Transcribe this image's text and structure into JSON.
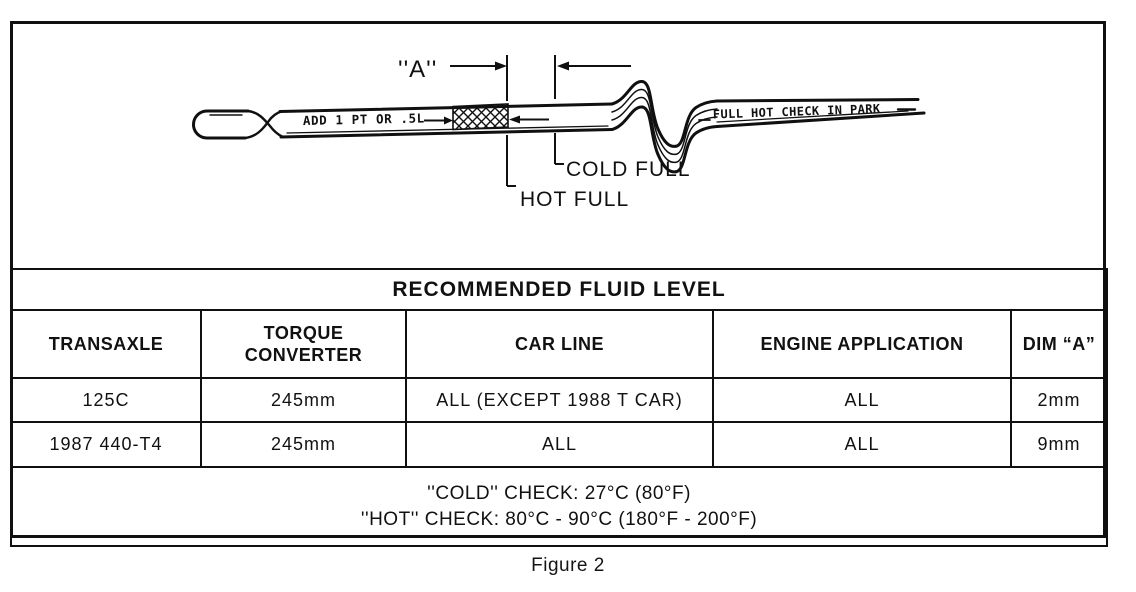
{
  "figure": {
    "caption": "Figure 2"
  },
  "diagram": {
    "dim_a_label": "''A''",
    "dipstick_add_text": "ADD 1 PT OR .5L",
    "dipstick_full_text": "FULL HOT CHECK IN PARK",
    "cold_full_label": "COLD FULL",
    "hot_full_label": "HOT FULL"
  },
  "table": {
    "title": "RECOMMENDED FLUID LEVEL",
    "columns": [
      "TRANSAXLE",
      "TORQUE CONVERTER",
      "CAR LINE",
      "ENGINE APPLICATION",
      "DIM “A”"
    ],
    "rows": [
      [
        "125C",
        "245mm",
        "ALL (EXCEPT 1988 T CAR)",
        "ALL",
        "2mm"
      ],
      [
        "1987 440-T4",
        "245mm",
        "ALL",
        "ALL",
        "9mm"
      ]
    ],
    "notes": [
      "''COLD'' CHECK: 27°C (80°F)",
      "''HOT'' CHECK: 80°C - 90°C (180°F - 200°F)"
    ]
  }
}
